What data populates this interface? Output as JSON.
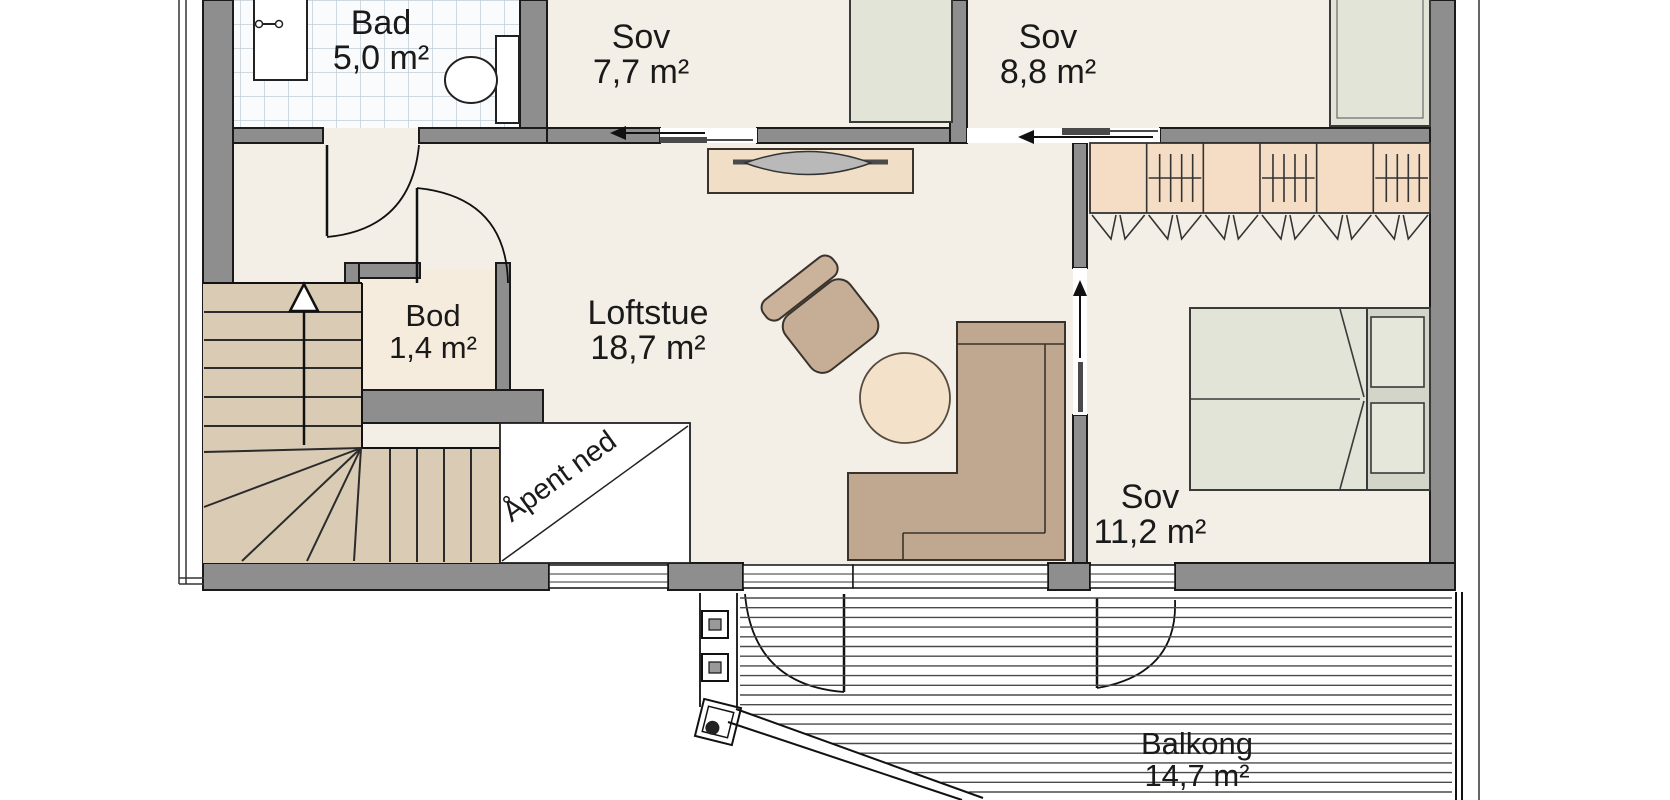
{
  "rooms": [
    {
      "id": "bad",
      "name": "Bad",
      "area": "5,0 m²"
    },
    {
      "id": "sov-1",
      "name": "Sov",
      "area": "7,7 m²"
    },
    {
      "id": "sov-2",
      "name": "Sov",
      "area": "8,8 m²"
    },
    {
      "id": "bod",
      "name": "Bod",
      "area": "1,4 m²"
    },
    {
      "id": "loftstue",
      "name": "Loftstue",
      "area": "18,7 m²"
    },
    {
      "id": "sov-3",
      "name": "Sov",
      "area": "11,2 m²"
    },
    {
      "id": "balkong",
      "name": "Balkong",
      "area": "14,7 m²"
    }
  ],
  "annotations": {
    "open_below": "Åpent ned"
  },
  "colors": {
    "wall": "#8e8e8e",
    "floor": "#f3efe6",
    "tile_bg": "#fafbfd",
    "tile_grid": "#c2cdd6",
    "stairs": "#dacbb4",
    "cabinet": "#f4ddc4",
    "bed": "#e1e4d7",
    "sofa": "#bfa88f",
    "armchair": "#c6ae96",
    "table": "#f3e2c9",
    "void": "#ffffff",
    "line": "#1a1a1a"
  }
}
